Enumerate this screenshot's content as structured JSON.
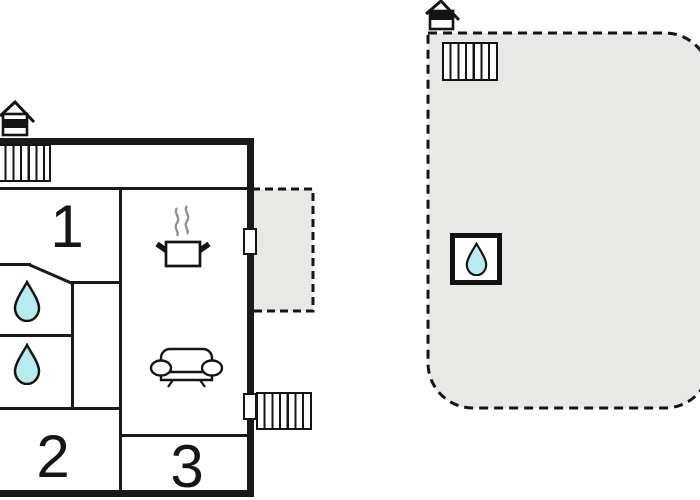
{
  "plan": {
    "rooms": [
      {
        "id": "room-1",
        "label": "1"
      },
      {
        "id": "room-2",
        "label": "2"
      },
      {
        "id": "room-3",
        "label": "3"
      }
    ],
    "colors": {
      "wall": "#1a1a1a",
      "terrace_fill": "#e8e8e7",
      "water_drop_fill": "#b6ecee",
      "steam": "#8f8f8f"
    },
    "icons": [
      "chimney-icon",
      "stairs-icon",
      "door",
      "water-drop-icon",
      "cooking-pot-icon",
      "steam-icon",
      "sofa-icon",
      "framed-water-drop-icon"
    ]
  }
}
